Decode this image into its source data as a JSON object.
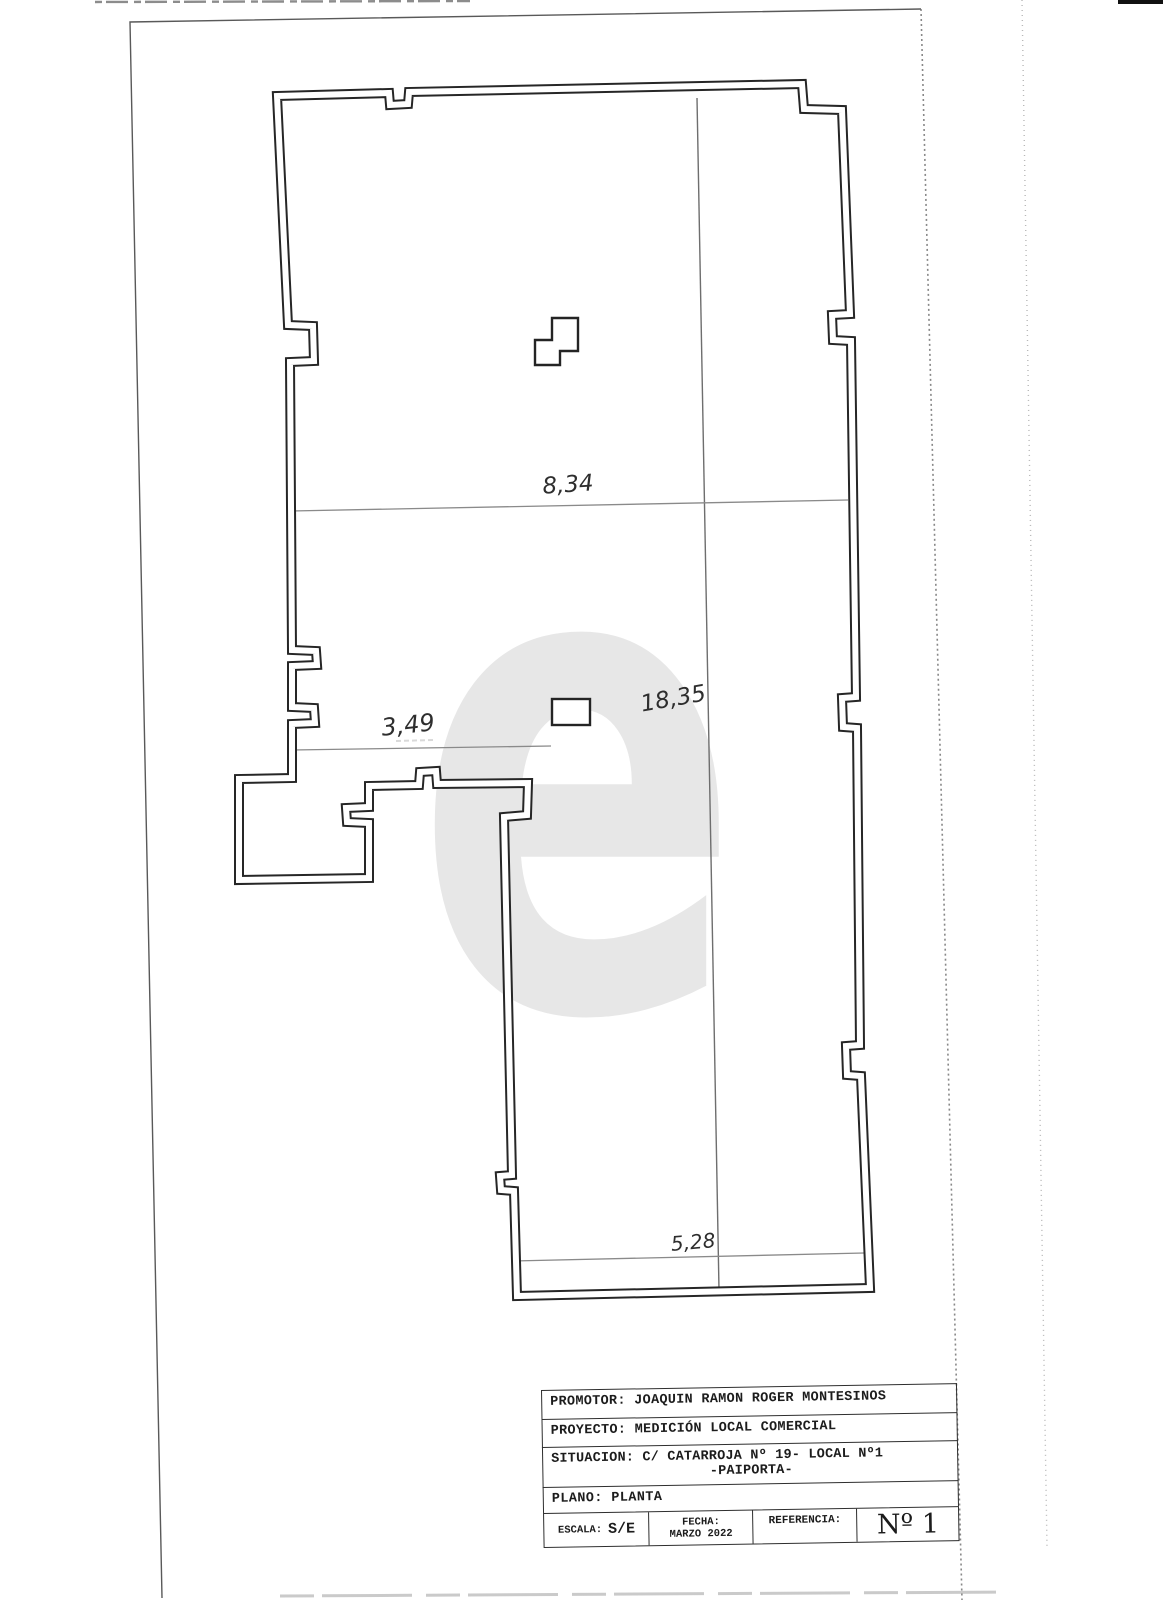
{
  "plan": {
    "watermark": "e",
    "dimensions": [
      {
        "id": "dim-top",
        "text": "8,34"
      },
      {
        "id": "dim-right",
        "text": "18,35"
      },
      {
        "id": "dim-left",
        "text": "3,49"
      },
      {
        "id": "dim-bottom",
        "text": "5,28"
      }
    ]
  },
  "title_block": {
    "rows": [
      {
        "label": "PROMOTOR:",
        "value": "JOAQUIN RAMON ROGER MONTESINOS"
      },
      {
        "label": "PROYECTO:",
        "value": "MEDICIÓN LOCAL COMERCIAL"
      },
      {
        "label": "SITUACION:",
        "value": "C/ CATARROJA Nº 19- LOCAL Nº1",
        "value2": "-PAIPORTA-"
      },
      {
        "label": "PLANO:",
        "value": "PLANTA"
      }
    ],
    "footer": {
      "escala_label": "ESCALA:",
      "escala_value": "S/E",
      "fecha_label": "FECHA:",
      "fecha_value": "MARZO 2022",
      "referencia_label": "REFERENCIA:",
      "sheet_number": "Nº 1"
    }
  }
}
